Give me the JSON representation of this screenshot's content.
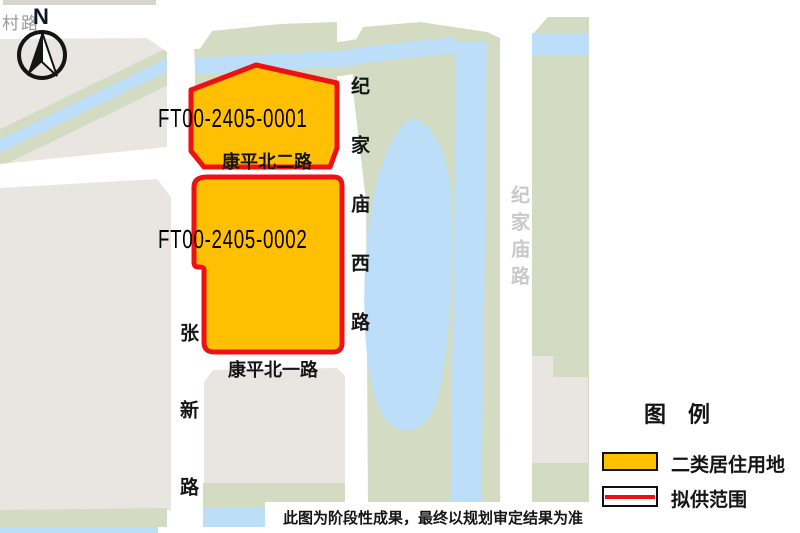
{
  "colors": {
    "c-page": "#ffffff",
    "c-beige": "#e9e6e2",
    "c-green": "#d3dcc3",
    "c-water": "#bcdef9",
    "c-orange": "#ffc003",
    "c-red": "#ee1111",
    "c-road-label-gray": "#c9c9c9",
    "c-strip": "#d8d5d1",
    "c-corner-text": "#9a9a9a",
    "c-ink": "#151515"
  },
  "map": {
    "corner_text": "村路",
    "compass_label": "N",
    "parcels": [
      {
        "id": "FT00-2405-0001"
      },
      {
        "id": "FT00-2405-0002"
      }
    ],
    "road_labels": {
      "kangping_bei_er_lu": "康平北二路",
      "kangping_bei_yi_lu": "康平北一路",
      "jijiamiao_xi_lu": "纪家庙西路",
      "jijiamiao_lu": "纪家庙路",
      "zhangxin_lu": "张新路"
    }
  },
  "legend": {
    "title": "图　例",
    "items": [
      {
        "label": "二类居住用地"
      },
      {
        "label": "拟供范围"
      }
    ]
  },
  "footer": {
    "disclaimer": "此图为阶段性成果，最终以规划审定结果为准"
  }
}
